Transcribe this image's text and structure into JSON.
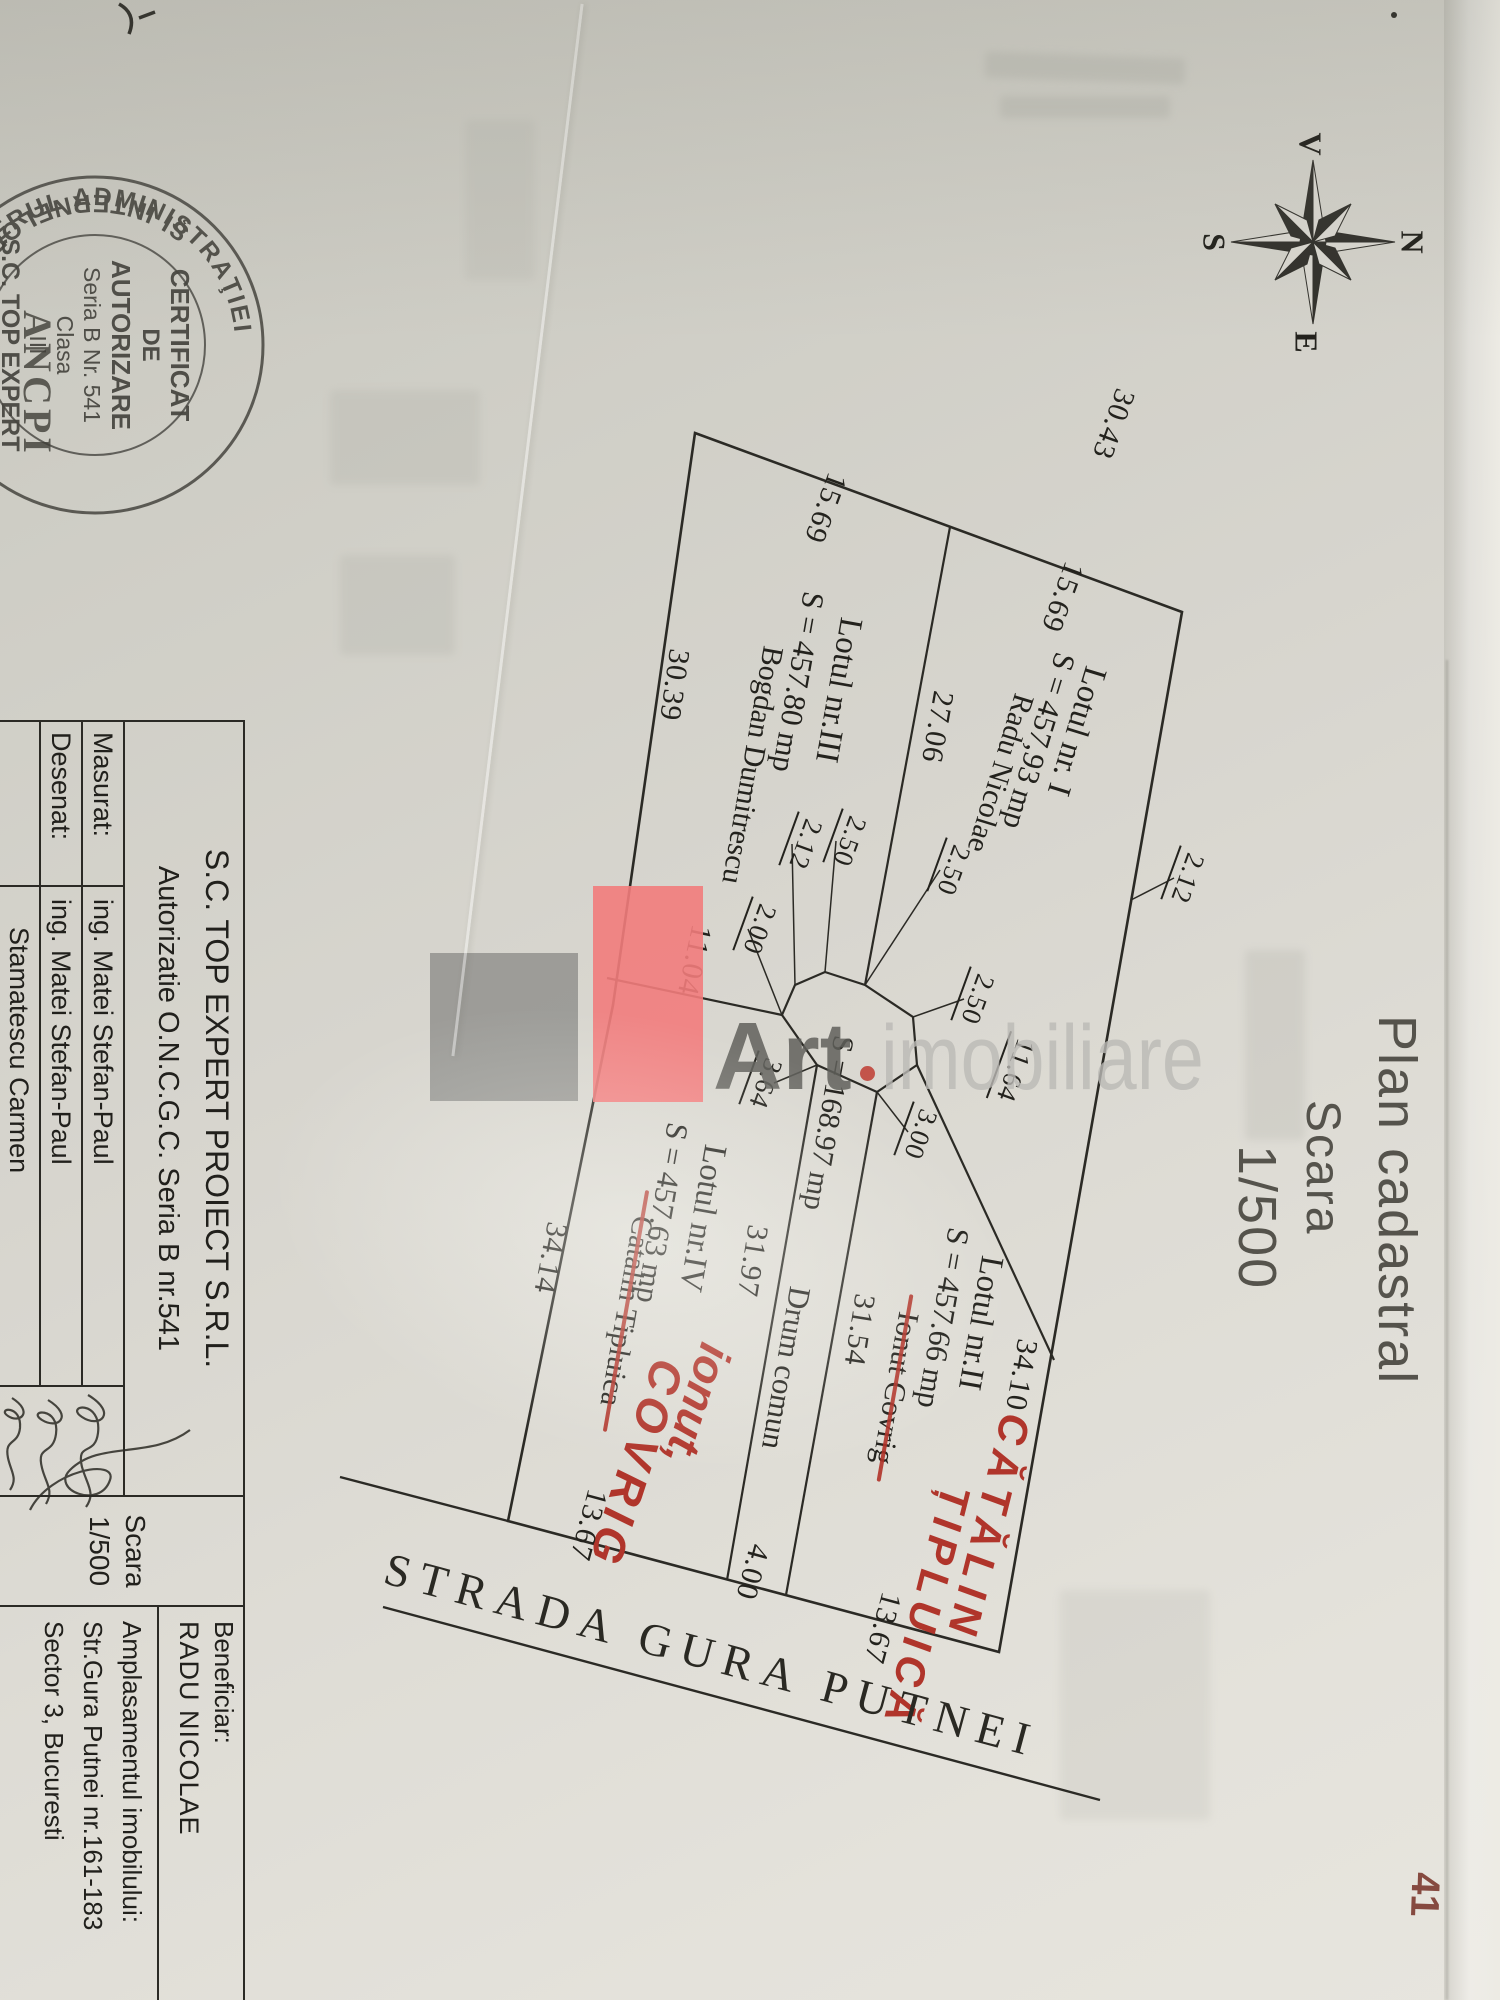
{
  "plan_title": {
    "l1": "Plan cadastral",
    "l2": "Scara",
    "l3": "1/500"
  },
  "compass": {
    "n": "N",
    "s": "S",
    "e": "E",
    "w": "V"
  },
  "stamp": {
    "arc_top": "MINISTERUL ADMINISTRAŢIEI",
    "arc_bottom": "ŞI INTERNELOR",
    "org": "ANCPI",
    "l1": "CERTIFICAT",
    "l2": "DE",
    "l3": "AUTORIZARE",
    "l4": "Seria B Nr. 541",
    "l5": "Clasa",
    "l6": "III",
    "l7": "S.C. TOP EXPERT",
    "l8": "PROIECT S.R.L."
  },
  "watermark": {
    "bold": "Art",
    "light": "imobiliare"
  },
  "street_name": "STRADA GURA PUTNEI",
  "road": {
    "name": "Drum comun",
    "area": "S = 168.97 mp"
  },
  "lots": {
    "lot1": {
      "name": "Lotul nr. I",
      "area": "S = 457,93 mp",
      "owner": "Radu Nicolae"
    },
    "lot2": {
      "name": "Lotul nr.II",
      "area": "S = 457.66 mp",
      "owner": "Ionut Covrig",
      "note1": "CĂTĂLIN",
      "note2": "ȚIPLUICĂ"
    },
    "lot3": {
      "name": "Lotul nr.III",
      "area": "S = 457.80 mp",
      "owner": "Bogdan Dumitrescu"
    },
    "lot4": {
      "name": "Lotul nr.IV",
      "area": "S = 457.63 mp",
      "owner": "Catalin Tipluica",
      "note1": "ionut,",
      "note2": "COVRIG"
    }
  },
  "dims": {
    "d1": "15.69",
    "d2": "15.69",
    "d3": "30.43",
    "d4": "27.06",
    "d5": "30.39",
    "d6": "11.04",
    "d7": "34.14",
    "d8": "2.50",
    "d9": "2.12",
    "d10": "2.50",
    "d11": "2.50",
    "d12": "2.12",
    "d13": "2.00",
    "d14": "3.64",
    "d15": "11.64",
    "d16": "3.00",
    "d17": "31.97",
    "d18": "31.54",
    "d19": "34.10",
    "d20": "13.67",
    "d21": "4.00",
    "d22": "13.67"
  },
  "table": {
    "company": "S.C. TOP EXPERT PROIECT S.R.L.",
    "authorization": "Autorizatie O.N.C.G.C. Seria B nr.541",
    "rows": [
      {
        "label": "Masurat:",
        "name": "ing. Matei Stefan-Paul"
      },
      {
        "label": "Desenat:",
        "name": "ing. Matei Stefan-Paul"
      },
      {
        "label": "",
        "name": "Stamatescu Carmen"
      }
    ],
    "scale_label": "Scara",
    "scale_value": "1/500",
    "beneficiary_label": "Beneficiar:",
    "beneficiary": "RADU NICOLAE",
    "location_label": "Amplasamentul imobilului:",
    "location_line1": "Str.Gura Putnei nr.161-183",
    "location_line2": "Sector 3, Bucuresti"
  },
  "marks": {
    "corner": "41"
  }
}
